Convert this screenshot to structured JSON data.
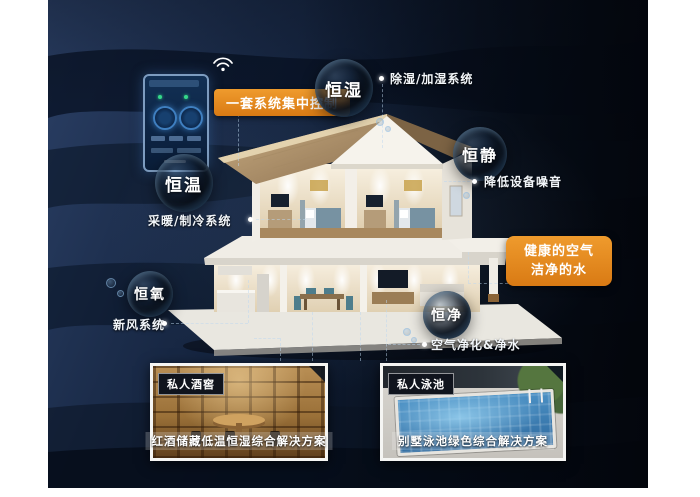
{
  "palette": {
    "accent_orange": "#e0831c",
    "background_navy": "#101e36"
  },
  "control_panel": {
    "label": "一套系统集中控制"
  },
  "features": [
    {
      "name": "恒湿",
      "note": "除湿/加湿系统"
    },
    {
      "name": "恒静",
      "note": "降低设备噪音"
    },
    {
      "name": "恒温",
      "note": "采暖/制冷系统"
    },
    {
      "name": "恒氧",
      "note": "新风系统"
    },
    {
      "name": "恒净",
      "note": "空气净化&净水"
    }
  ],
  "highlight": {
    "line1": "健康的空气",
    "line2": "洁净的水"
  },
  "cards": [
    {
      "badge": "私人酒窖",
      "caption": "红酒储藏低温恒湿综合解决方案"
    },
    {
      "badge": "私人泳池",
      "caption": "别墅泳池绿色综合解决方案"
    }
  ]
}
